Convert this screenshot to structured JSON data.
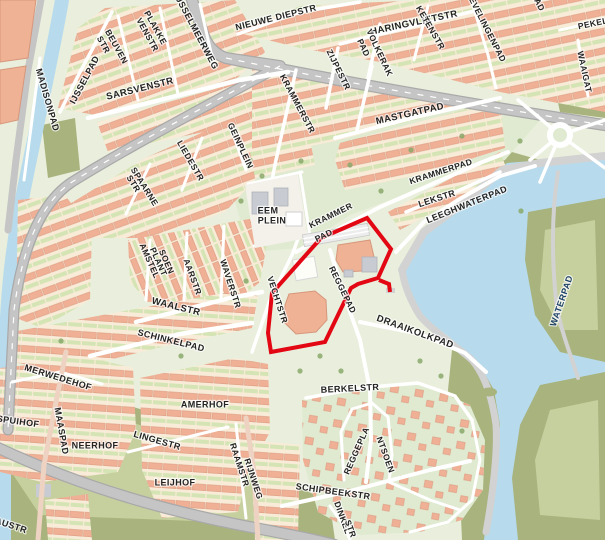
{
  "map": {
    "kind": "street-map",
    "description": "Dutch residential neighborhood street map with lake on the right, canal on the left, and a red-outlined highlighted parcel in the center (school/plantsoen area around Reggepad and Vechtstr).",
    "highlight": {
      "meaning": "red boundary around selected area",
      "color": "#e30613"
    },
    "colors": {
      "land": "#e9efdc",
      "park": "#dfead0",
      "olive": "#a8b37e",
      "olive_inner": "#c6d09e",
      "water": "#b7dbec",
      "quay": "#d2d2d2",
      "block": "#f8ecd8",
      "house": "#efb095",
      "house_border": "#dc9c82",
      "garden": "#d5e4b4",
      "road_white": "#ffffff",
      "road_grey": "#c5c5c5",
      "road_casing": "#a9a9a9",
      "pink_road": "#eed3c3",
      "building": "#f0b295",
      "building_border": "#d6977c",
      "building_grey": "#c8ccd2",
      "plaza": "#f3f1ea",
      "tree": "#8aa86b",
      "red": "#e30613",
      "label": "#232323",
      "water_label": "#1c4066"
    },
    "labels": [
      {
        "t": "MADISONPAD",
        "x": 47,
        "y": 100,
        "r": 74,
        "s": 9
      },
      {
        "t": "IJSSELPAD",
        "x": 85,
        "y": 80,
        "r": -62,
        "s": 9
      },
      {
        "t": "BEUVEN",
        "x": 116,
        "y": 47,
        "r": 61,
        "s": 8.5
      },
      {
        "t": "STR",
        "x": 103,
        "y": 45,
        "r": 61,
        "s": 8.5
      },
      {
        "t": "PLAKKE",
        "x": 155,
        "y": 28,
        "r": 61,
        "s": 8.5
      },
      {
        "t": "VENSTR",
        "x": 147,
        "y": 35,
        "r": 61,
        "s": 8.5
      },
      {
        "t": "IJSSELMEERWEG",
        "x": 196,
        "y": 32,
        "r": 62,
        "s": 9
      },
      {
        "t": "NIEUWE DIEPSTR",
        "x": 276,
        "y": 18,
        "r": -14,
        "s": 9
      },
      {
        "t": "SARSVENSTR",
        "x": 140,
        "y": 89,
        "r": -14,
        "s": 9.5
      },
      {
        "t": "HARINGVLIETSTR",
        "x": 414,
        "y": 23,
        "r": -12,
        "s": 9.5
      },
      {
        "t": "PAD",
        "x": 363,
        "y": 48,
        "r": 65,
        "s": 8.5
      },
      {
        "t": "VOLKERAK",
        "x": 379,
        "y": 53,
        "r": 65,
        "s": 8.5
      },
      {
        "t": "KETENSTR",
        "x": 430,
        "y": 28,
        "r": 60,
        "s": 8.5
      },
      {
        "t": "EVELINGENPAD",
        "x": 487,
        "y": 30,
        "r": 63,
        "s": 8.5
      },
      {
        "t": "PEKEL",
        "x": 593,
        "y": 24,
        "r": -12,
        "s": 8.5
      },
      {
        "t": "AD",
        "x": 539,
        "y": 5,
        "r": 63,
        "s": 8.5
      },
      {
        "t": "ZIJPESTR",
        "x": 338,
        "y": 70,
        "r": 64,
        "s": 8.5
      },
      {
        "t": "KRAMMERSTR",
        "x": 297,
        "y": 104,
        "r": 62,
        "s": 8.5
      },
      {
        "t": "MASTGATPAD",
        "x": 410,
        "y": 114,
        "r": -13,
        "s": 9.5
      },
      {
        "t": "WAAIGAT",
        "x": 584,
        "y": 72,
        "r": 78,
        "s": 8.5
      },
      {
        "t": "GEINPLEIN",
        "x": 240,
        "y": 146,
        "r": 65,
        "s": 8.5
      },
      {
        "t": "LIEDESTR",
        "x": 190,
        "y": 161,
        "r": 60,
        "s": 8.5
      },
      {
        "t": "SPAARNE",
        "x": 144,
        "y": 187,
        "r": 58,
        "s": 8.5
      },
      {
        "t": "STR",
        "x": 133,
        "y": 184,
        "r": 58,
        "s": 8.5
      },
      {
        "t": "EEM",
        "x": 268,
        "y": 211,
        "r": 0,
        "s": 9
      },
      {
        "t": "PLEIN",
        "x": 272,
        "y": 221,
        "r": 0,
        "s": 9
      },
      {
        "t": "KRAMMER",
        "x": 331,
        "y": 216,
        "r": -26,
        "s": 8.5
      },
      {
        "t": "PAD",
        "x": 324,
        "y": 236,
        "r": -26,
        "s": 8.5
      },
      {
        "t": "KRAMMERPAD",
        "x": 441,
        "y": 172,
        "r": -18,
        "s": 8.5
      },
      {
        "t": "LEKSTR",
        "x": 437,
        "y": 199,
        "r": -18,
        "s": 9
      },
      {
        "t": "LEEGHWATERPAD",
        "x": 467,
        "y": 205,
        "r": -22,
        "s": 9
      },
      {
        "t": "AMSTEL",
        "x": 149,
        "y": 261,
        "r": 66,
        "s": 8.5
      },
      {
        "t": "PLANT",
        "x": 158,
        "y": 262,
        "r": 66,
        "s": 8.5
      },
      {
        "t": "SOEN",
        "x": 166,
        "y": 262,
        "r": 66,
        "s": 8.5
      },
      {
        "t": "AARSTR",
        "x": 192,
        "y": 277,
        "r": 70,
        "s": 8.5
      },
      {
        "t": "WAVERSTR",
        "x": 230,
        "y": 284,
        "r": 72,
        "s": 8.5
      },
      {
        "t": "VECHTSTR",
        "x": 277,
        "y": 300,
        "r": 72,
        "s": 8.5
      },
      {
        "t": "WAALSTR",
        "x": 176,
        "y": 307,
        "r": 14,
        "s": 9.5
      },
      {
        "t": "REGGEPAD",
        "x": 342,
        "y": 290,
        "r": 64,
        "s": 8.5
      },
      {
        "t": "DRAAIKOLKPAD",
        "x": 415,
        "y": 332,
        "r": 20,
        "s": 9.5
      },
      {
        "t": "SCHINKELPAD",
        "x": 171,
        "y": 341,
        "r": 14,
        "s": 9
      },
      {
        "t": "MERWEDEHOF",
        "x": 58,
        "y": 378,
        "r": 17,
        "s": 9
      },
      {
        "t": "SPUIHOF",
        "x": 18,
        "y": 422,
        "r": 8,
        "s": 9
      },
      {
        "t": "MAASPAD",
        "x": 61,
        "y": 431,
        "r": 80,
        "s": 9
      },
      {
        "t": "NEERHOF",
        "x": 95,
        "y": 446,
        "r": 0,
        "s": 9
      },
      {
        "t": "AMERHOF",
        "x": 205,
        "y": 405,
        "r": 0,
        "s": 9
      },
      {
        "t": "LINGESTR",
        "x": 157,
        "y": 441,
        "r": 16,
        "s": 9
      },
      {
        "t": "LEIJHOF",
        "x": 175,
        "y": 483,
        "r": 0,
        "s": 9
      },
      {
        "t": "RAAMSTR",
        "x": 239,
        "y": 465,
        "r": 72,
        "s": 8.5
      },
      {
        "t": "RIJNWEG",
        "x": 253,
        "y": 479,
        "r": 72,
        "s": 8.5
      },
      {
        "t": "AUSTR",
        "x": 11,
        "y": 526,
        "r": 18,
        "s": 9
      },
      {
        "t": "BERKELSTR",
        "x": 350,
        "y": 389,
        "r": -3,
        "s": 9
      },
      {
        "t": "REGGEPLA",
        "x": 357,
        "y": 451,
        "r": -66,
        "s": 8.5
      },
      {
        "t": "NTSOEN",
        "x": 385,
        "y": 455,
        "r": 70,
        "s": 8.5
      },
      {
        "t": "SCHIPBEEKSTR",
        "x": 333,
        "y": 492,
        "r": 8,
        "s": 9
      },
      {
        "t": "DINKEL",
        "x": 342,
        "y": 518,
        "r": 70,
        "s": 8.5
      },
      {
        "t": "STR",
        "x": 350,
        "y": 529,
        "r": 70,
        "s": 8.5
      },
      {
        "t": "WATERPAD",
        "x": 562,
        "y": 301,
        "r": -71,
        "s": 9,
        "c": "#1c4066"
      }
    ]
  }
}
